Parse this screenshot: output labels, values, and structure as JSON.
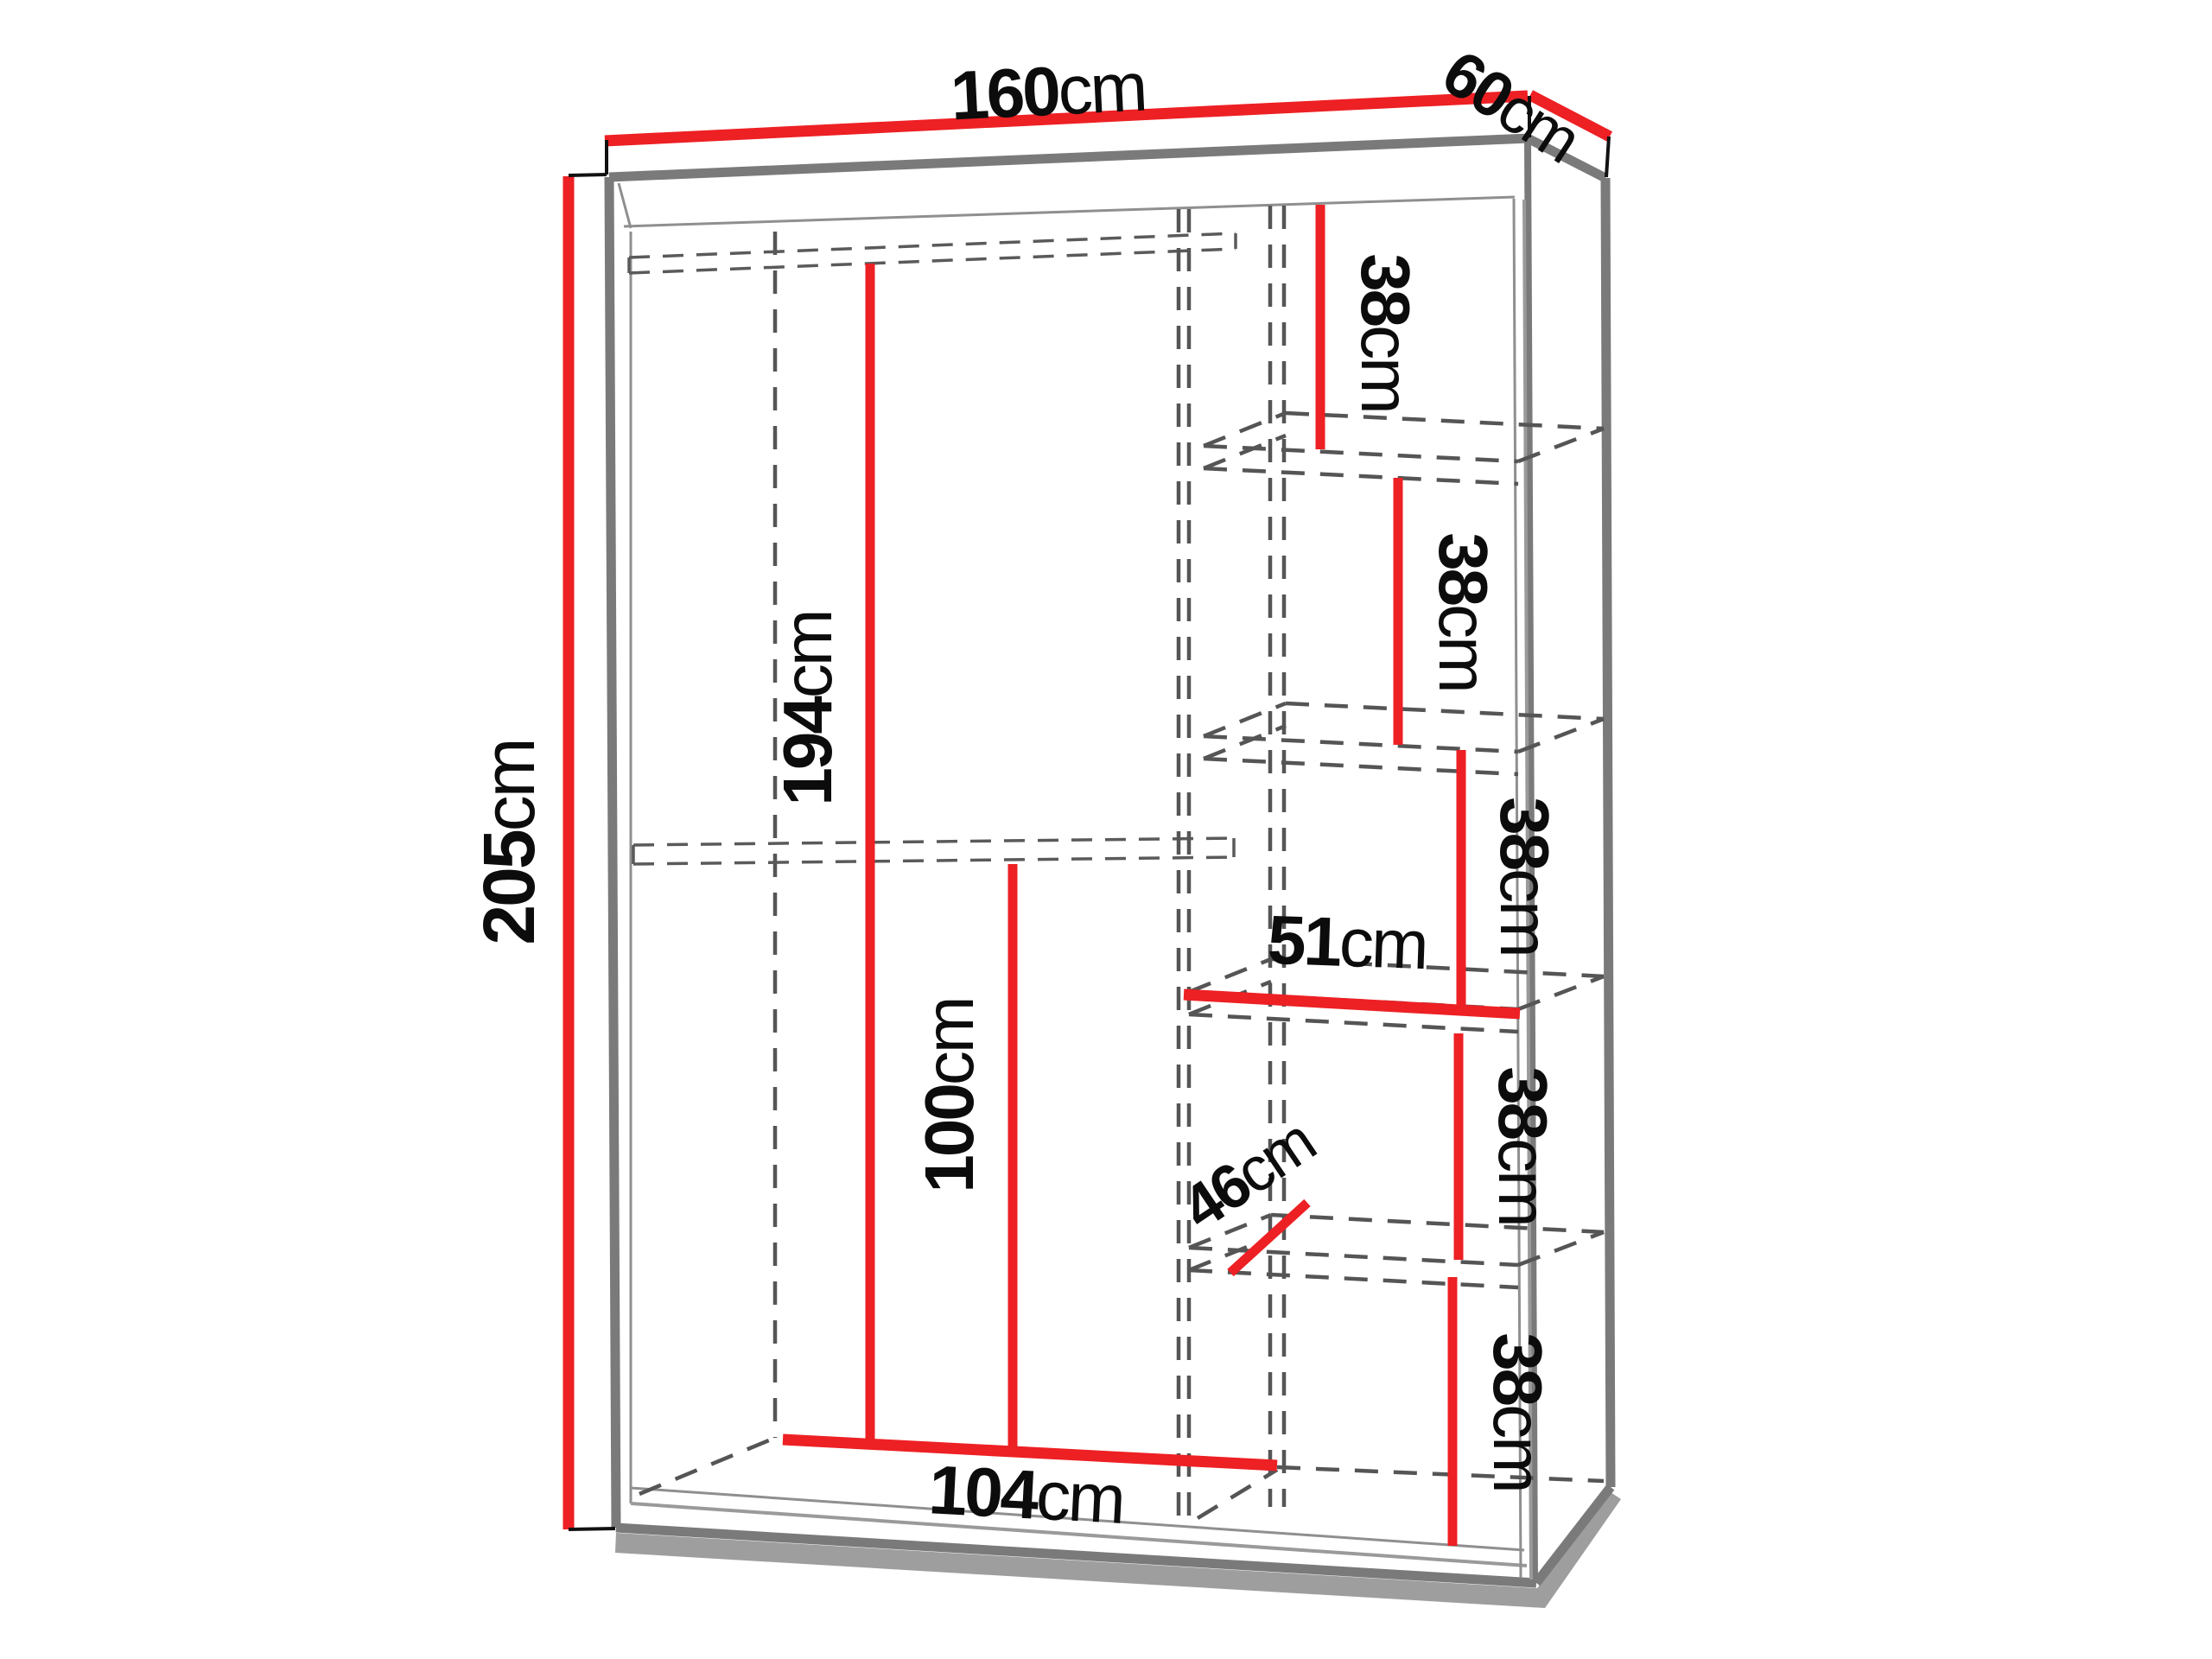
{
  "drawing": {
    "description": "3D technical line drawing of a wardrobe with internal shelf dimensions",
    "unit": "cm",
    "colors": {
      "dimension_line": "#ed2024",
      "outline": "#7a7a7a",
      "hidden_line": "#555555",
      "label_text": "#0c0c0c",
      "shadow": "#9e9e9e",
      "background": "#ffffff"
    },
    "dims": {
      "width": {
        "value": "160",
        "unit": "cm"
      },
      "depth": {
        "value": "60",
        "unit": "cm"
      },
      "height": {
        "value": "205",
        "unit": "cm"
      },
      "hanging_height": {
        "value": "194",
        "unit": "cm"
      },
      "lower_height": {
        "value": "100",
        "unit": "cm"
      },
      "interior_width": {
        "value": "104",
        "unit": "cm"
      },
      "shelf_width": {
        "value": "51",
        "unit": "cm"
      },
      "shelf_depth": {
        "value": "46",
        "unit": "cm"
      },
      "shelf_gap_1": {
        "value": "38",
        "unit": "cm"
      },
      "shelf_gap_2": {
        "value": "38",
        "unit": "cm"
      },
      "shelf_gap_3": {
        "value": "38",
        "unit": "cm"
      },
      "shelf_gap_4": {
        "value": "38",
        "unit": "cm"
      },
      "shelf_gap_5": {
        "value": "38",
        "unit": "cm"
      }
    }
  }
}
